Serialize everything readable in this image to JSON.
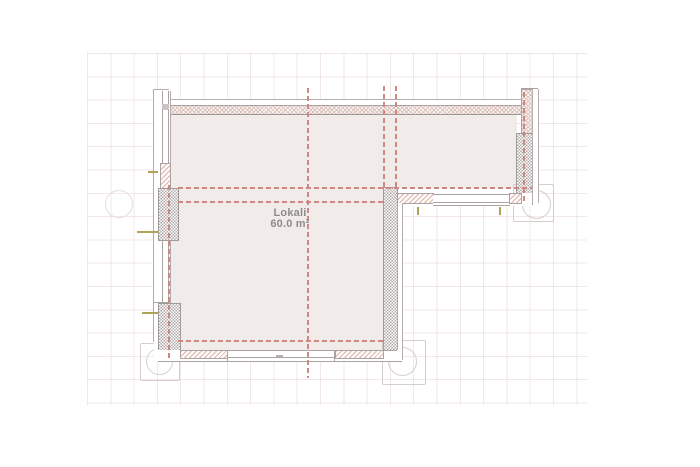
{
  "plan": {
    "room": {
      "label": "Lokali",
      "area": "60.0 m²"
    }
  },
  "colors": {
    "floor": "#f1ebe9",
    "axis_line": "#cd837c",
    "wall_line": "#a8a09e",
    "hatch_pink": "#e0b3ab",
    "wall_hatch_tan": "#dcc2bc",
    "checker_gray": "#b5adab",
    "column_outline": "#d6cecc",
    "window_tick_olive": "#b2a258",
    "label_text": "#8d8d8d",
    "grid": "#f2e7e6"
  }
}
